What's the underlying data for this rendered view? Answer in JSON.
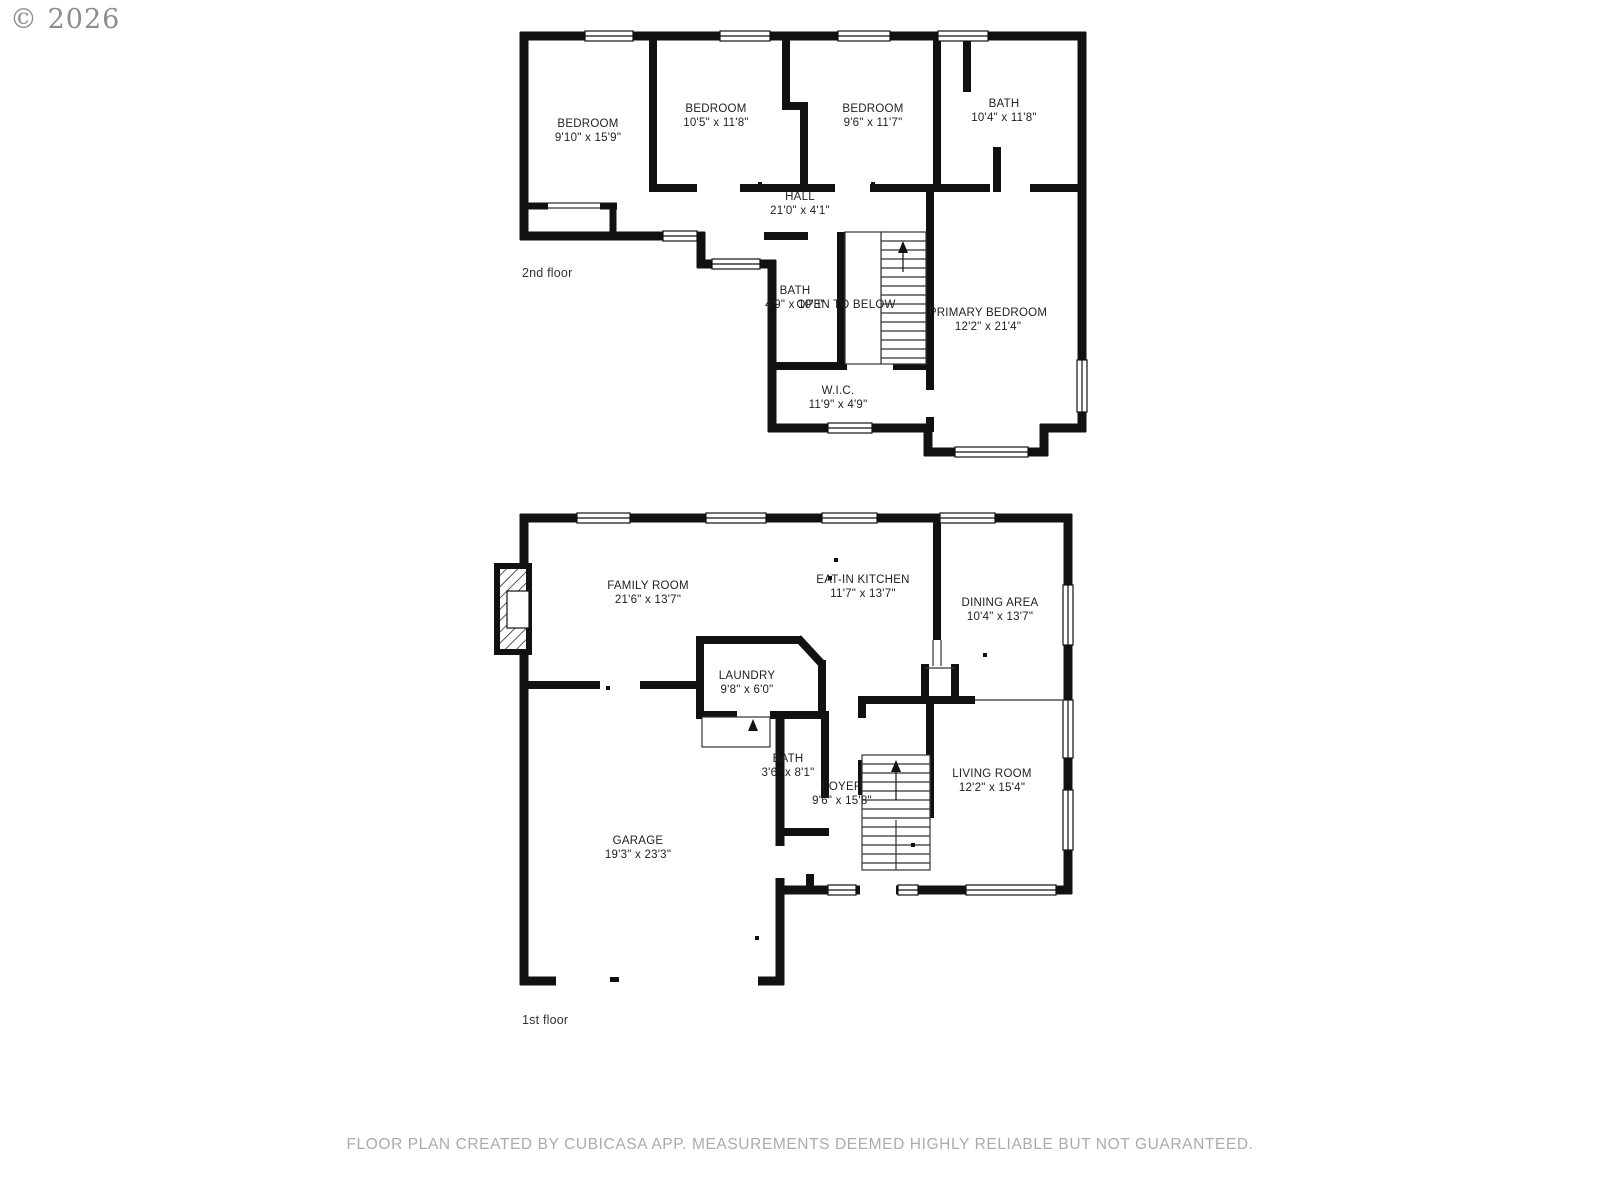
{
  "copyright": "© 2026",
  "footer": "FLOOR PLAN CREATED BY CUBICASA APP. MEASUREMENTS DEEMED HIGHLY RELIABLE BUT NOT GUARANTEED.",
  "colors": {
    "wall": "#111111",
    "label_text": "#1f1f1f",
    "muted_text": "#ababab",
    "copyright_text": "#8d8d8d"
  },
  "second_floor": {
    "floor_label": "2nd floor",
    "rooms": [
      {
        "name": "BEDROOM",
        "dims": "9'10\" x 15'9\""
      },
      {
        "name": "BEDROOM",
        "dims": "10'5\" x 11'8\""
      },
      {
        "name": "BEDROOM",
        "dims": "9'6\" x 11'7\""
      },
      {
        "name": "BATH",
        "dims": "10'4\" x 11'8\""
      },
      {
        "name": "HALL",
        "dims": "21'0\" x 4'1\""
      },
      {
        "name": "BATH",
        "dims": "4'9\" x 10'3\""
      },
      {
        "name": "OPEN TO BELOW",
        "dims": ""
      },
      {
        "name": "PRIMARY BEDROOM",
        "dims": "12'2\" x 21'4\""
      },
      {
        "name": "W.I.C.",
        "dims": "11'9\" x 4'9\""
      }
    ]
  },
  "first_floor": {
    "floor_label": "1st floor",
    "rooms": [
      {
        "name": "FAMILY ROOM",
        "dims": "21'6\" x 13'7\""
      },
      {
        "name": "EAT-IN KITCHEN",
        "dims": "11'7\" x 13'7\""
      },
      {
        "name": "DINING AREA",
        "dims": "10'4\" x 13'7\""
      },
      {
        "name": "LAUNDRY",
        "dims": "9'8\" x 6'0\""
      },
      {
        "name": "BATH",
        "dims": "3'6\" x 8'1\""
      },
      {
        "name": "FOYER",
        "dims": "9'6\" x 15'8\""
      },
      {
        "name": "LIVING ROOM",
        "dims": "12'2\" x 15'4\""
      },
      {
        "name": "GARAGE",
        "dims": "19'3\" x 23'3\""
      }
    ]
  }
}
